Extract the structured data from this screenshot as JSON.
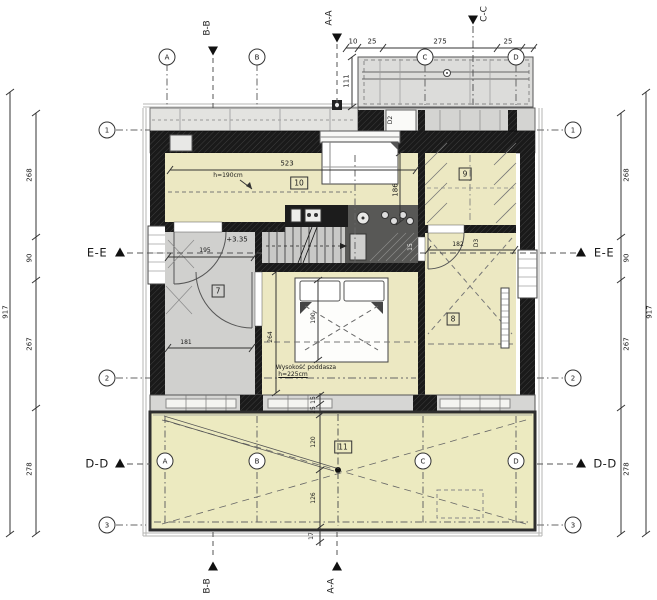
{
  "drawing": {
    "type": "floor-plan",
    "level_label": "+3.35"
  },
  "colors": {
    "room_fill": "#ece8c2",
    "roof_fill": "#eceac0",
    "hall_fill": "#d0d0ce",
    "balcony_fill": "#dcdcda",
    "wall_dark": "#1c1c1c",
    "line": "#444444"
  },
  "sections": {
    "aa": "A-A",
    "bb": "B-B",
    "cc": "C-C",
    "dd": "D-D",
    "ee": "E-E"
  },
  "grid": {
    "letters": [
      "A",
      "B",
      "C",
      "D"
    ],
    "numbers": [
      "1",
      "2",
      "3"
    ]
  },
  "rooms": {
    "r7": "7",
    "r8": "8",
    "r9": "9",
    "r10": "10",
    "r11": "11"
  },
  "doors": {
    "d2": "D2",
    "d3": "D3"
  },
  "levels": {
    "attic": "+3.35"
  },
  "notes": {
    "attic_line1": "Wysokość poddasza",
    "attic_line2": "h=225cm",
    "niche_height": "h=190cm"
  },
  "dims": {
    "total": "917",
    "chain": [
      "268",
      "90",
      "267",
      "278"
    ],
    "top": [
      "10",
      "25",
      "275",
      "25"
    ],
    "balcony_depth": "111",
    "room10_width": "523",
    "room10_depth": "186",
    "hall_width": "195",
    "hall_width2": "181",
    "bedroom_side": "264",
    "bed_length": "190",
    "room8_width": "182",
    "bath_wall": "15",
    "roof": [
      "15",
      "25",
      "120",
      "126",
      "17"
    ]
  }
}
